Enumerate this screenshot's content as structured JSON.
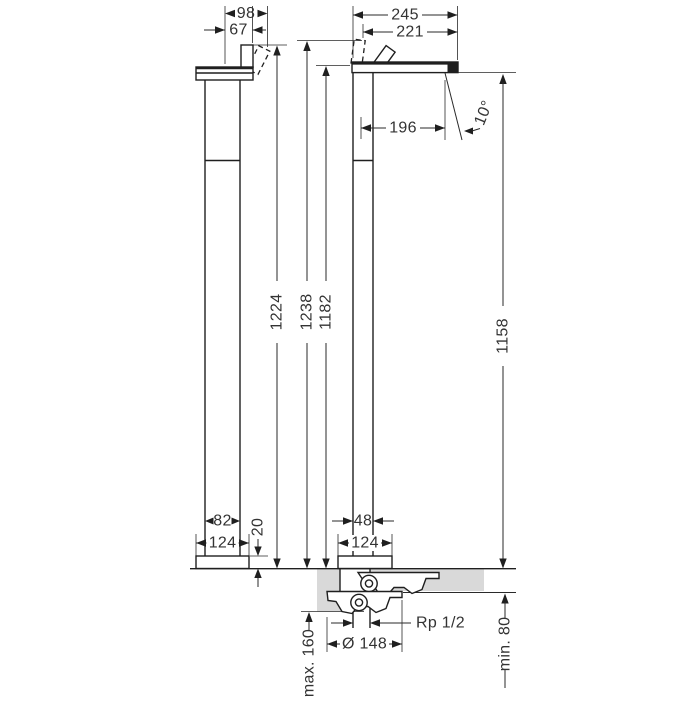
{
  "drawing": {
    "kind": "technical-dimension-drawing",
    "units": "mm",
    "colors": {
      "line": "#1f1f1f",
      "floor": "#d9d9d9",
      "background": "#ffffff"
    },
    "side_view": {
      "dim_98": "98",
      "dim_67": "67",
      "dim_1224": "1224",
      "dim_82": "82",
      "dim_124": "124",
      "dim_20": "20"
    },
    "front_view": {
      "dim_245": "245",
      "dim_221": "221",
      "dim_196": "196",
      "angle": "10°",
      "dim_1238": "1238",
      "dim_1182": "1182",
      "dim_1158": "1158",
      "dim_48": "48",
      "dim_124": "124"
    },
    "installation": {
      "max_floor": "max. 160",
      "diameter": "Ø 148",
      "thread": "Rp 1/2",
      "min_floor": "min. 80"
    }
  }
}
